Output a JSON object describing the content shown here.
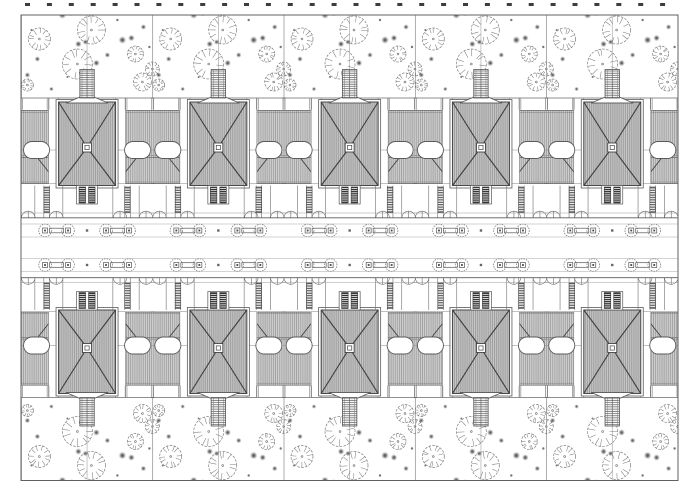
{
  "meta": {
    "drawing_type": "architectural-site-plan",
    "description": "Row housing site plan: two mirrored rows of five hip-roof courtyard houses with rear gardens, linked pergola bands, entry stairs, and a central street with paired street trees",
    "background": "#ffffff"
  },
  "canvas": {
    "width": 700,
    "height": 495
  },
  "colors": {
    "line": "#5a5a5a",
    "line_dark": "#3f3f3f",
    "line_light": "#9a9a9a",
    "band_fill": "#cdcdcd",
    "band_line": "#8d8d8d",
    "roof_fill": "#c7c7c7",
    "roof_line": "#858585",
    "tree_line": "#7d7d7d",
    "bush_fill": "#383838",
    "dash_fill": "#3d3d3d",
    "white": "#ffffff"
  },
  "layout": {
    "units_per_row": 5,
    "unit_pitch": 131.3,
    "first_unit_left": 21.4,
    "mirror_axis": 247.75,
    "border": {
      "left": 21,
      "right": 678,
      "top": 15,
      "bottom": 480.5
    }
  },
  "top_dashes": {
    "y": 3,
    "w": 5,
    "h": 3,
    "start": 25,
    "spacing": 21.9
  },
  "garden": {
    "top": 15,
    "bottom": 98,
    "fence_ticks": {
      "start_rel": 11.6,
      "spacing": 22,
      "count": 6,
      "len": 3.4
    },
    "trees": [
      {
        "x": 70,
        "y": 30,
        "r": 14
      },
      {
        "x": 56,
        "y": 64,
        "r": 15
      },
      {
        "x": 18,
        "y": 39,
        "r": 11
      },
      {
        "x": 114,
        "y": 54,
        "r": 8
      },
      {
        "x": 121,
        "y": 82,
        "r": 9
      },
      {
        "x": 6,
        "y": 85,
        "r": 6
      },
      {
        "x": 131,
        "y": 69,
        "r": 7
      }
    ],
    "bushes": [
      {
        "x": 41,
        "y": 15,
        "r": 3.5
      },
      {
        "x": 50,
        "y": 13,
        "r": 3
      },
      {
        "x": 101,
        "y": 40,
        "r": 3.5
      },
      {
        "x": 110,
        "y": 38,
        "r": 3
      },
      {
        "x": 86,
        "y": 55,
        "r": 2.5
      },
      {
        "x": 6,
        "y": 75,
        "r": 2.5
      },
      {
        "x": 57,
        "y": 44,
        "r": 3
      },
      {
        "x": 64,
        "y": 42,
        "r": 2.5
      },
      {
        "x": 16,
        "y": 59,
        "r": 2.5
      },
      {
        "x": 75,
        "y": 63,
        "r": 3
      },
      {
        "x": 30,
        "y": 89,
        "r": 2
      },
      {
        "x": 122,
        "y": 27,
        "r": 2.5
      }
    ],
    "dots": [
      {
        "x": 96,
        "y": 20,
        "r": 1.2
      },
      {
        "x": 10,
        "y": 30,
        "r": 1
      },
      {
        "x": 128,
        "y": 47,
        "r": 1.2
      },
      {
        "x": 46,
        "y": 77,
        "r": 1
      }
    ]
  },
  "house": {
    "porch": {
      "top": 98,
      "bottom": 110,
      "post_offsets": [
        39,
        65.6
      ]
    },
    "stair_top": {
      "half_w": 7.2,
      "y1": 69.5,
      "y2": 98,
      "rung_step": 2.2
    },
    "prow": {
      "half_w_base": 21,
      "half_w_top": 7.5,
      "y_base": 103,
      "y_top": 97.2
    },
    "band": {
      "top": 110,
      "bottom": 158
    },
    "wing": {
      "top": 158,
      "bottom": 183.5
    },
    "wing_diag": {
      "x1_off": 30.5,
      "y1": 182,
      "x2_off": 49,
      "y2": 158.5
    },
    "axis_line_y": 150,
    "side_column": {
      "off1": 28.5,
      "off2": 38.5,
      "top": 98,
      "bottom": 183.5
    },
    "capsule": {
      "center_off": 50.5,
      "len": 26,
      "y1": 141.5,
      "y2": 158.5
    },
    "eave": {
      "half_w": 31,
      "y1": 99.5,
      "y2": 188
    },
    "roof": {
      "half_w": 28.5,
      "y1": 102,
      "y2": 185.5,
      "apex_y": 147.5
    },
    "chimney": {
      "size": 9,
      "inner": 4.2,
      "y": 143
    },
    "vestibule": {
      "half_w": 10.5,
      "y1": 185.5,
      "y2": 204
    },
    "dark_stairs": {
      "off1": 1.5,
      "off2": 8,
      "y1": 187,
      "y2": 203
    },
    "side_ladders": {
      "off1": 37.6,
      "off2": 43.1,
      "y1": 187,
      "y2": 212.5
    },
    "facade_vlines": [
      -52.2,
      -43.2,
      -37.7,
      -24.2,
      25.8,
      37.8,
      43.3,
      52.1
    ],
    "facade_hline_y": 213,
    "facade_y1": 185.5,
    "facade_y2": 217.8,
    "arc_groups": {
      "starts_off": [
        -65.6,
        -37.6,
        26.2,
        52.2
      ],
      "r": 6.78,
      "baseline": 218
    }
  },
  "street": {
    "top_y": 217.8,
    "mid_lines": [
      224,
      237
    ],
    "row_y": 230.5,
    "tree_offsets": [
      -42,
      -19,
      19,
      42
    ],
    "pairs": [
      [
        0,
        1
      ],
      [
        2,
        3
      ]
    ],
    "center_dot": {
      "size": 2.4
    },
    "item": {
      "circle_r": 6.3,
      "square": 5,
      "inner_dot": 1.8,
      "bar_half_h": 2.3
    }
  },
  "random_seed": 7
}
